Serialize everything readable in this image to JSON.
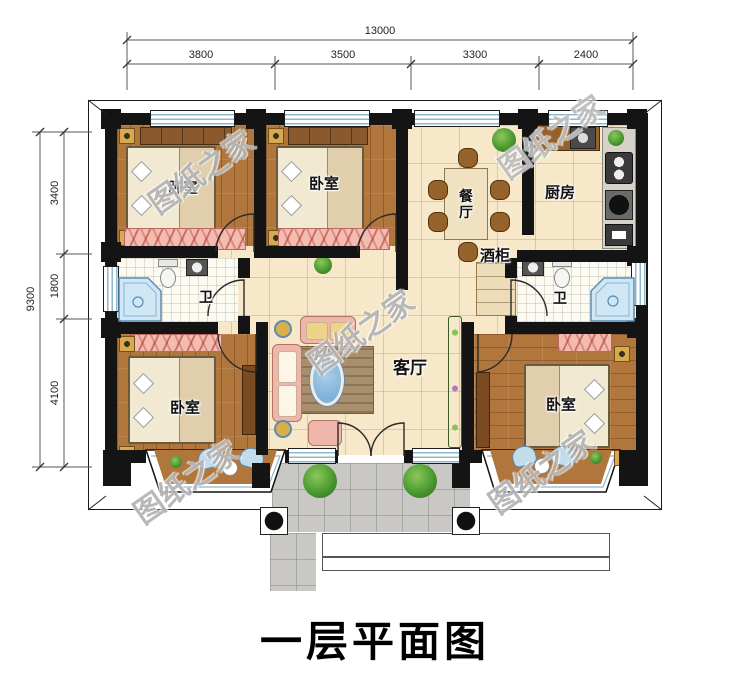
{
  "title": "一层平面图",
  "watermark_text": "图纸之家",
  "dimensions": {
    "top": {
      "total": "13000",
      "segments": [
        "3800",
        "3500",
        "3300",
        "2400"
      ]
    },
    "left": {
      "total": "9300",
      "segments": [
        "3400",
        "1800",
        "4100"
      ]
    }
  },
  "rooms": {
    "bedroom_top_left": "卧室",
    "bedroom_top_middle": "卧室",
    "dining_room": "餐厅",
    "kitchen": "厨房",
    "wine_cabinet": "酒柜",
    "bathroom_left": "卫",
    "bathroom_right": "卫",
    "living_room": "客厅",
    "bedroom_bottom_left": "卧室",
    "bedroom_bottom_right": "卧室"
  },
  "colors": {
    "wall": "#141414",
    "wood_floor": "#b0763c",
    "tile_floor": "#f6e8c8",
    "bath_floor": "#fcfbf3",
    "porch": "#c9c8c4",
    "window_stripe": "#8fb8cc",
    "rug_pink": "#f4bbb0",
    "sofa_pink": "#efb6ab",
    "coffee_table_blue": "#7fb2d8",
    "shower_blue": "#cfe6f4",
    "plant_green": "#4a9a30"
  }
}
